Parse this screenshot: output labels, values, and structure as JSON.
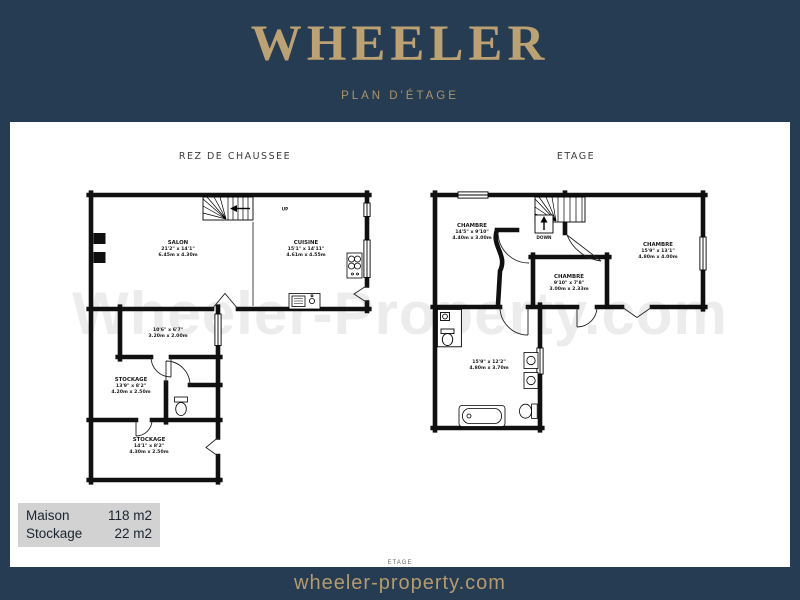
{
  "header": {
    "brand": "WHEELER",
    "subtitle": "PLAN D'ÉTAGE"
  },
  "watermark": "Wheeler-Property.com",
  "plans": {
    "ground": {
      "title": "REZ DE CHAUSSEE",
      "stairs_label": "UP",
      "rooms": {
        "salon": {
          "name": "SALON",
          "imperial": "21'2\" x 14'1\"",
          "metric": "6.45m x 4.30m"
        },
        "cuisine": {
          "name": "CUISINE",
          "imperial": "15'1\" x 14'11\"",
          "metric": "4.61m x 4.55m"
        },
        "hall": {
          "imperial": "10'6\" x 6'7\"",
          "metric": "3.20m x 2.00m"
        },
        "stockage1": {
          "name": "STOCKAGE",
          "imperial": "13'9\" x 8'2\"",
          "metric": "4.20m x 2.50m"
        },
        "stockage2": {
          "name": "STOCKAGE",
          "imperial": "14'1\" x 8'2\"",
          "metric": "4.30m x 2.50m"
        }
      }
    },
    "upper": {
      "title": "ETAGE",
      "stairs_label": "DOWN",
      "cropped_label": "ETAGE",
      "rooms": {
        "chambre1": {
          "name": "CHAMBRE",
          "imperial": "14'5\" x 9'10\"",
          "metric": "4.40m x 3.00m"
        },
        "chambre2": {
          "name": "CHAMBRE",
          "imperial": "15'9\" x 13'1\"",
          "metric": "4.80m x 4.00m"
        },
        "chambre3": {
          "name": "CHAMBRE",
          "imperial": "9'10\" x 7'8\"",
          "metric": "3.00m x 2.33m"
        },
        "bathroom": {
          "imperial": "15'9\" x 12'2\"",
          "metric": "4.80m x 3.70m"
        }
      }
    }
  },
  "legend": {
    "rows": [
      {
        "label": "Maison",
        "value": "118 m2"
      },
      {
        "label": "Stockage",
        "value": "22 m2"
      }
    ]
  },
  "footer": {
    "url": "wheeler-property.com"
  },
  "colors": {
    "navy": "#263c52",
    "gold": "#b89e6f",
    "legend_bg": "#d2d2d2",
    "watermark": "#ececec"
  }
}
